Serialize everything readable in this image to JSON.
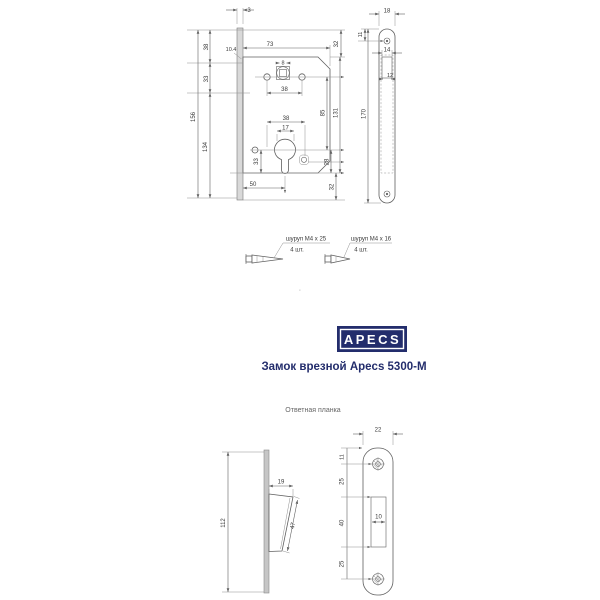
{
  "brand": {
    "logo_text": "APECS",
    "title": "Замок врезной Apecs 5300-M",
    "navy": "#232d6c"
  },
  "lock_body_view": {
    "dims": {
      "plate_thickness": "3",
      "upper_left": "38",
      "plate_offset": "10.4",
      "mid_left": "33",
      "total_height": "156",
      "inner_height": "134",
      "body_width": "73",
      "upper_right": "32",
      "follower_square": "8",
      "handle_holes_span": "38",
      "centers_distance": "85",
      "body_height": "131",
      "cyl_holes_span": "38",
      "cyl_width": "17",
      "cyl_left": "33",
      "cyl_right": "28",
      "backset": "50",
      "lower_right": "32"
    }
  },
  "faceplate_view": {
    "dims": {
      "width": "18",
      "screw_offset": "11",
      "latch_width": "14",
      "latch_inner": "12",
      "height": "170"
    }
  },
  "screws": {
    "left": {
      "label": "шуруп M4 x 25",
      "qty": "4 шт."
    },
    "right": {
      "label": "шуруп M4 x 16",
      "qty": "4 шт."
    }
  },
  "strike_plate": {
    "caption": "Ответная планка",
    "side_view": {
      "dims": {
        "height": "112",
        "tongue_width": "19",
        "tongue_length": "47"
      }
    },
    "front_view": {
      "dims": {
        "width": "22",
        "screw_offset": "11",
        "upper": "25",
        "cutout_height": "40",
        "lower": "25",
        "cutout_width": "10"
      }
    }
  },
  "stray_mark": "'"
}
